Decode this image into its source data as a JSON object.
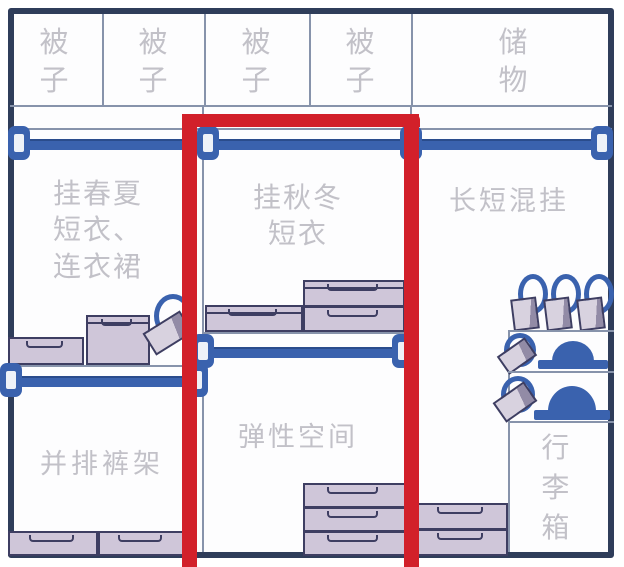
{
  "title": "wardrobe-storage-layout-diagram",
  "colors": {
    "frame_navy": "#2f3d5a",
    "grid_line": "#8793ab",
    "rod_blue": "#3a62ae",
    "box_fill": "#cfc6d9",
    "box_side_dark": "#928ba6",
    "box_border": "#3e3e62",
    "label_gray": "#c2c1c8",
    "highlight_red": "#d2202a"
  },
  "top_row": {
    "cells": [
      {
        "label": "被子"
      },
      {
        "label": "被子"
      },
      {
        "label": "被子"
      },
      {
        "label": "被子"
      },
      {
        "label": "储物"
      }
    ]
  },
  "sections": {
    "left": {
      "hanging_label": "挂春夏短衣、连衣裙",
      "hanging_lines": [
        "挂春夏",
        "短衣、",
        "连衣裙"
      ],
      "pants_rack_label": "并排裤架"
    },
    "middle": {
      "hanging_label": "挂秋冬短衣",
      "hanging_lines": [
        "挂秋冬",
        "短衣"
      ],
      "flex_label": "弹性空间"
    },
    "right": {
      "hanging_label": "长短混挂",
      "luggage_label": "行李箱"
    }
  }
}
